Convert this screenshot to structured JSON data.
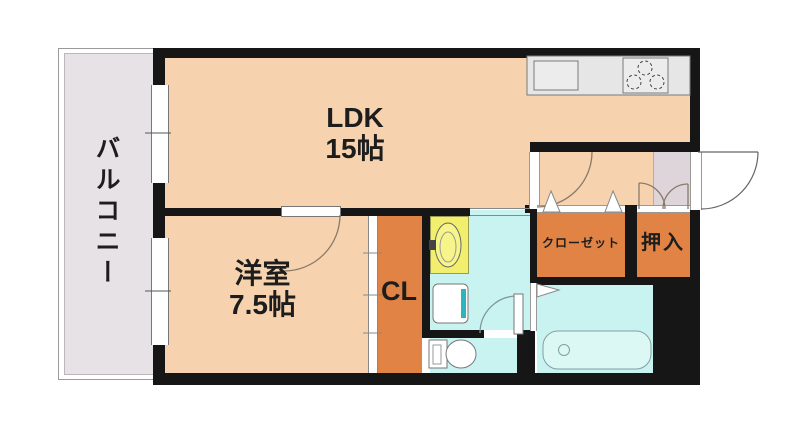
{
  "page": {
    "background": "#ffffff"
  },
  "colors": {
    "wall": "#161616",
    "floor-peach": "#f6d3ae",
    "balcony-grey": "#e7e2e5",
    "entrance-grey": "#ddd5d9",
    "closet-orange": "#e08345",
    "wet-cyan": "#c9f3f1",
    "basin-yellow": "#f2ee6e",
    "teal-accent": "#2fb3bd",
    "counter-grey": "#e6e6e6",
    "tub-cyan": "#dcf8f5"
  },
  "rooms": {
    "balcony": {
      "label": "バルコニー"
    },
    "ldk": {
      "label": "LDK",
      "size": "15帖"
    },
    "western_room": {
      "label": "洋室",
      "size": "7.5帖"
    },
    "cl": {
      "label": "CL"
    },
    "closet": {
      "label": "クローゼット"
    },
    "oshiire": {
      "label": "押入"
    }
  }
}
